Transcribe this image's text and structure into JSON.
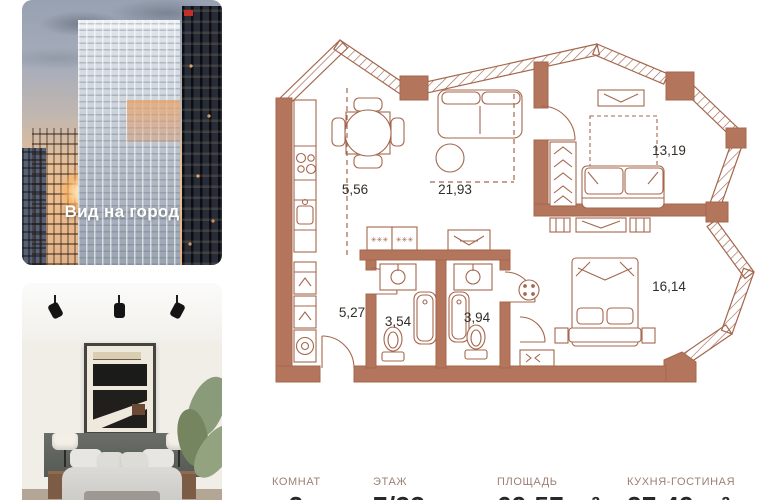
{
  "gallery": {
    "city_photo": {
      "caption": "Вид на город"
    }
  },
  "floorplan": {
    "rooms": [
      {
        "id": "kitchen",
        "area": "5,56"
      },
      {
        "id": "living-room",
        "area": "21,93"
      },
      {
        "id": "bedroom-1",
        "area": "13,19"
      },
      {
        "id": "bedroom-2",
        "area": "16,14"
      },
      {
        "id": "hallway",
        "area": "5,27"
      },
      {
        "id": "bathroom-1",
        "area": "3,54"
      },
      {
        "id": "bathroom-2",
        "area": "3,94"
      }
    ],
    "glyphs": {
      "stars": "✳✳✳"
    }
  },
  "summary": {
    "columns": [
      {
        "label": "КОМНАТ",
        "value": "2"
      },
      {
        "label": "ЭТАЖ",
        "value": "7/33"
      },
      {
        "label": "ПЛОЩАДЬ",
        "value": "69,57 м²"
      },
      {
        "label": "КУХНЯ-ГОСТИНАЯ",
        "value": "27,49 м²"
      }
    ]
  },
  "colors": {
    "plan_wall": "#b3755b",
    "plan_line": "#a4674e",
    "summary_label": "#9c8174",
    "summary_value": "#2b2724",
    "caption": "#ffffff"
  }
}
